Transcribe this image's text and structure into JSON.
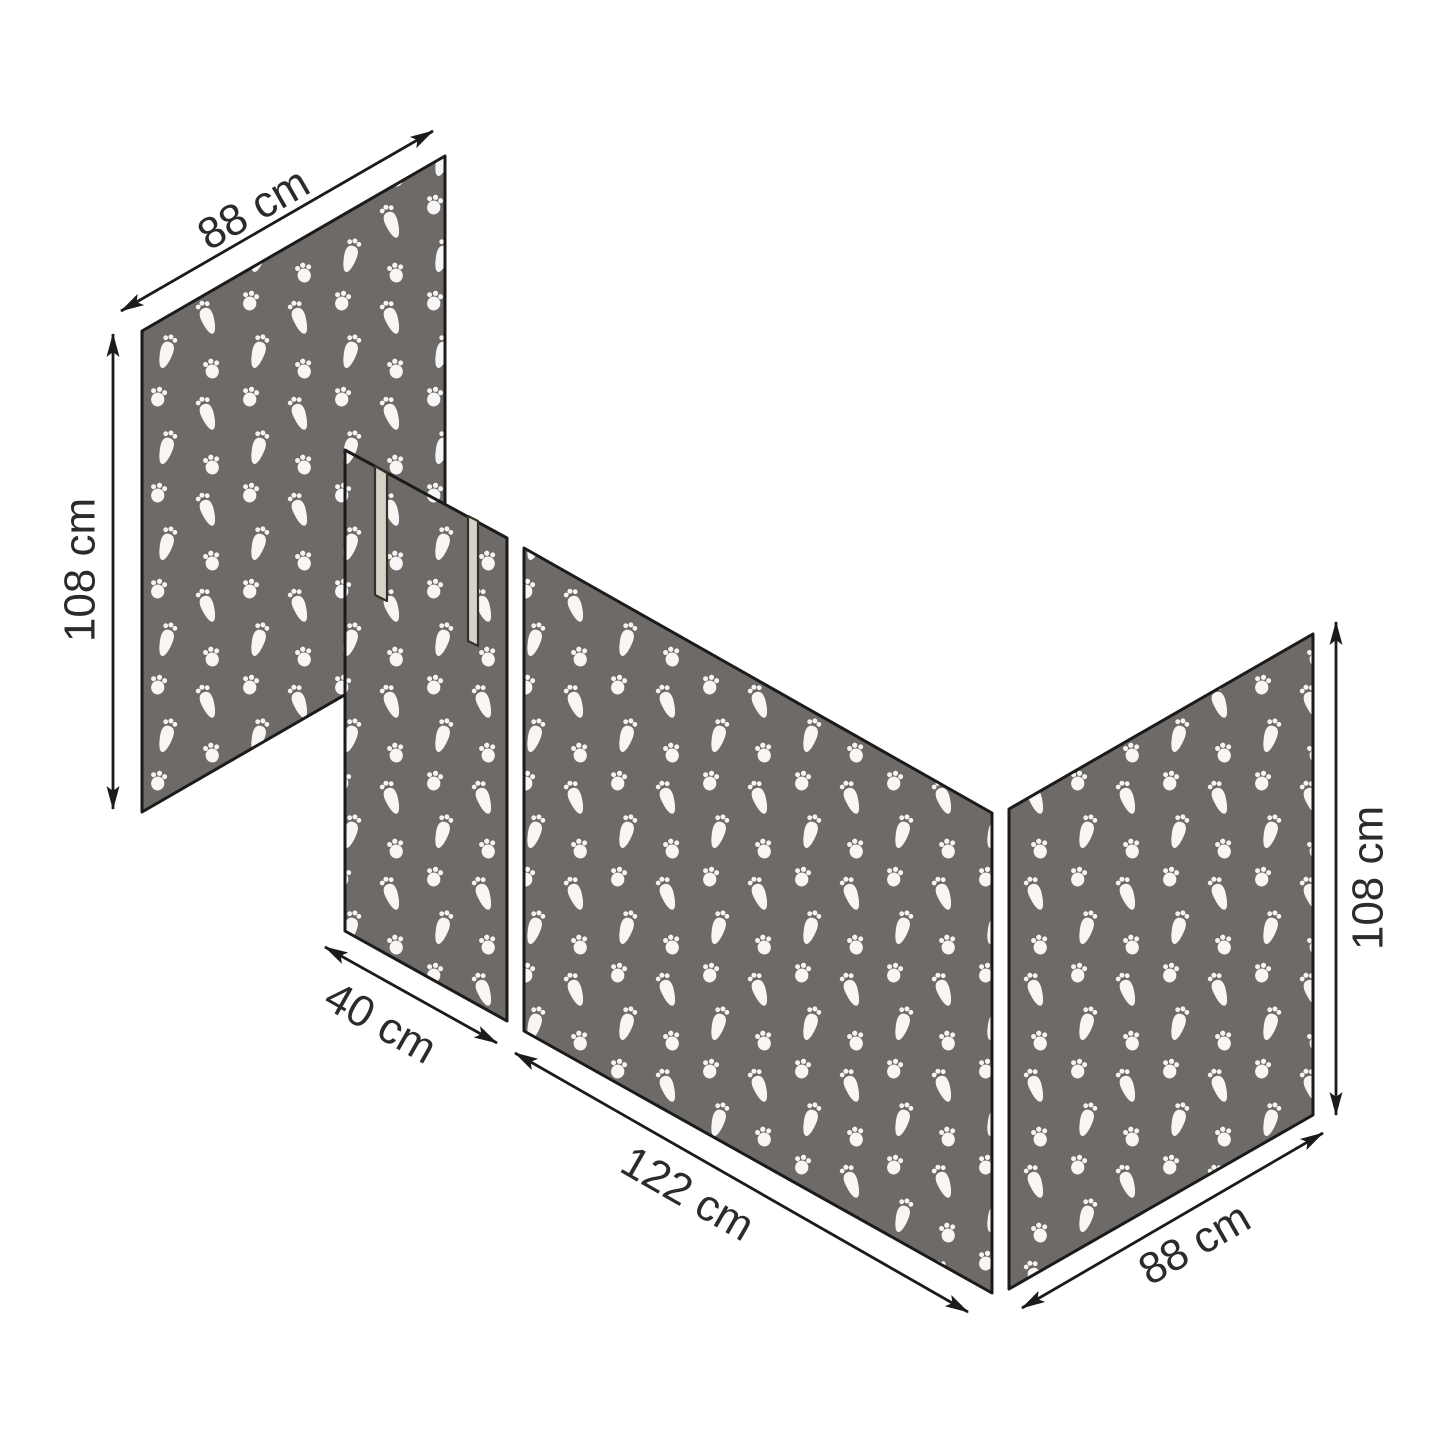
{
  "diagram": {
    "background_color": "#ffffff",
    "outline_color": "#1b1b1b",
    "text_color": "#2b2b2b",
    "fabric": {
      "fill_color": "#6d6a67",
      "pattern_color": "#f7f6f4",
      "pattern_motifs": [
        "rabbit-footprint-icon",
        "paw-print-icon"
      ]
    },
    "straps": {
      "count": 2,
      "fill_color": "#d6d2c7",
      "outline_color": "#35322c"
    },
    "panels": [
      {
        "name": "back-end-panel",
        "width": "88 cm",
        "height": "108 cm"
      },
      {
        "name": "door-panel",
        "width": "40 cm"
      },
      {
        "name": "front-side-panel",
        "width": "122 cm"
      },
      {
        "name": "foot-end-panel",
        "width": "88 cm",
        "height": "108 cm"
      }
    ],
    "dimensions": [
      {
        "id": "back-panel-width",
        "label": "88 cm"
      },
      {
        "id": "back-panel-height",
        "label": "108 cm"
      },
      {
        "id": "door-panel-width",
        "label": "40 cm"
      },
      {
        "id": "front-panel-width",
        "label": "122 cm"
      },
      {
        "id": "foot-panel-width",
        "label": "88 cm"
      },
      {
        "id": "foot-panel-height",
        "label": "108 cm"
      }
    ]
  }
}
